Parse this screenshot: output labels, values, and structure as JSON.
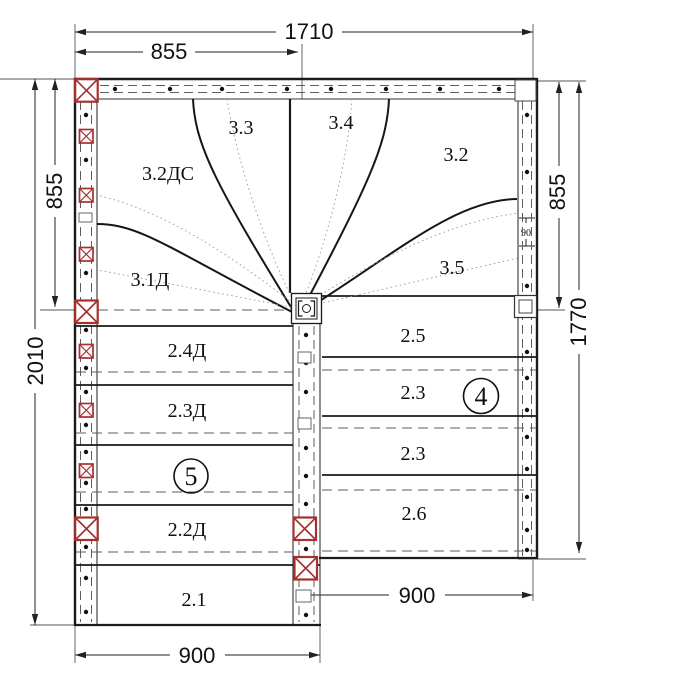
{
  "drawing": {
    "type": "stair-floor-plan",
    "dimensions": {
      "top_total": "1710",
      "top_left_half": "855",
      "left_upper": "855",
      "left_total": "2010",
      "right_upper": "855",
      "right_total": "1770",
      "wall_step": "90",
      "bottom_left": "900",
      "bottom_right": "900"
    },
    "flight_labels": {
      "s33": "3.3",
      "s34": "3.4",
      "s32ds": "3.2ДС",
      "s32": "3.2",
      "s31d": "3.1Д",
      "s35": "3.5",
      "s24d": "2.4Д",
      "s23d": "2.3Д",
      "s22d": "2.2Д",
      "s21": "2.1",
      "s25": "2.5",
      "s23a": "2.3",
      "s23b": "2.3",
      "s26": "2.6"
    },
    "callouts": {
      "left": "5",
      "right": "4"
    },
    "colors": {
      "marker_red": "#A43030",
      "line_black": "#1a1a1a",
      "dash_gray": "#5e5e5e",
      "dotted_gray": "#9a9a9a"
    }
  }
}
